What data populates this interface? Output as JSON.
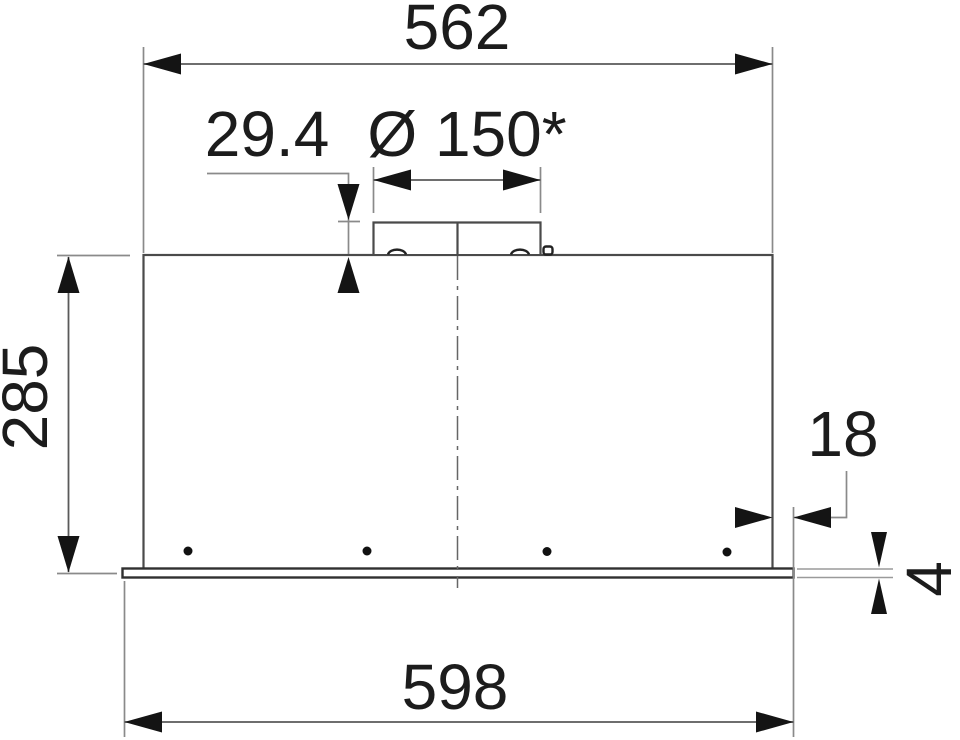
{
  "dimensions": {
    "top_width": "562",
    "collar_offset": "29.4",
    "duct_diameter": "Ø 150*",
    "body_height": "285",
    "flange_overhang": "18",
    "flange_thickness": "4",
    "bottom_width": "598"
  }
}
